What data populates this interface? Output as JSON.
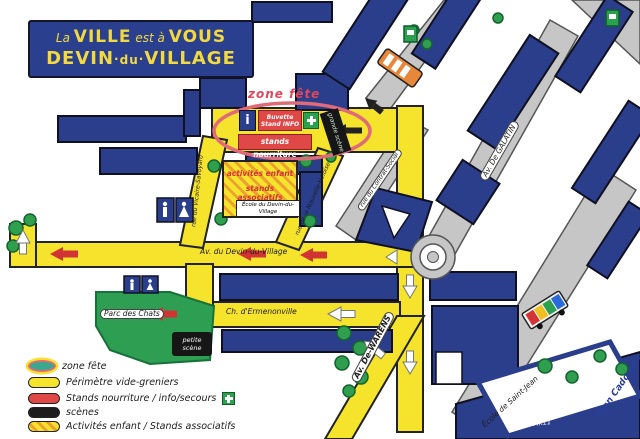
{
  "title": {
    "small1": "La",
    "big1": "VILLE",
    "small2": "est à",
    "big2": "VOUS",
    "l2w1": "DEVIN",
    "l2w2": "du",
    "l2w3": "VILLAGE",
    "sep": "·"
  },
  "zone_fete": {
    "label": "zone fête",
    "info_letter": "i",
    "buvette_line1": "Buvette",
    "buvette_line2": "Stand INFO",
    "stands_nourriture": "stands nourriture",
    "grande_scene": "grande scène"
  },
  "activites": {
    "line1": "activités enfant",
    "line2": "stands associatifs",
    "ecole": "École du Devin-du-Village"
  },
  "streets": {
    "devin": "Av. du Devin-du-Village",
    "ermenonville": "Ch. d'Ermenonville",
    "warens": "Av. De-WARENS",
    "galatin": "Av. De GALATIN",
    "contrat": "rue du Contrat-Social",
    "heloise": "rue de la Nouvelle-Héloïse",
    "vicaire": "rue du Vicaire-Savoyard"
  },
  "places": {
    "parc": "Parc des Chats",
    "petite_scene_line1": "petite",
    "petite_scene_line2": "scène",
    "ecole_saint_jean": "École de Saint-Jean"
  },
  "legend": {
    "items": [
      {
        "label": "zone fête",
        "swatch": "ellipse"
      },
      {
        "label": "Périmètre vide-greniers",
        "swatch": "yellow"
      },
      {
        "label": "Stands nourriture / info/secours",
        "swatch": "red",
        "icon": "green-cross"
      },
      {
        "label": "scènes",
        "swatch": "black"
      },
      {
        "label": "Activités enfant / Stands associatifs",
        "swatch": "hatched"
      }
    ]
  },
  "signature": {
    "artist": "Yann Cadorec'h",
    "note": "MK11"
  },
  "colors": {
    "building_blue": "#2a3e8c",
    "road_yellow": "#f6e32c",
    "road_gray": "#c6c6c6",
    "stand_red": "#e04848",
    "scene_black": "#161616",
    "park_green": "#2e9e53",
    "zone_outline_pink": "#e06a78",
    "secours_green": "#2ba04e",
    "title_yellow": "#f2d93f"
  }
}
